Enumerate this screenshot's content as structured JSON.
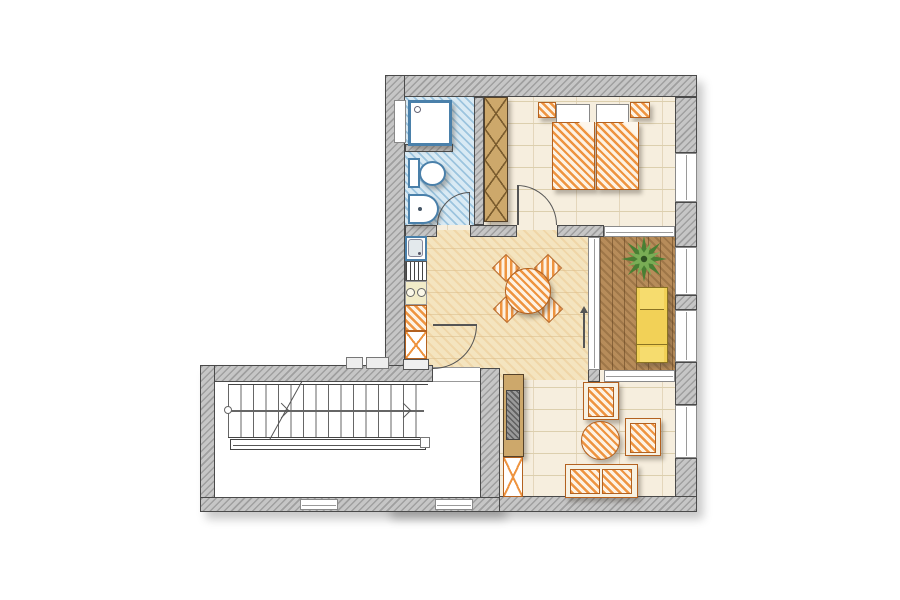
{
  "document": {
    "type": "architectural-floor-plan",
    "style": "hand-drawn color sketch, top-down apartment plan with stairwell wing",
    "visible_text": []
  },
  "colors": {
    "wall": "#c6c6c6",
    "wall_hatch": "#9f9f9f",
    "outline": "#4a4a4a",
    "floor": "#f6eede",
    "floor_line": "#dccfae",
    "dining_floor": "#f4e4bf",
    "bath_floor": "#d9eaf4",
    "bath_hatch": "#9cc4de",
    "fixture_blue": "#4a80aa",
    "balcony_floor": "#b78c5a",
    "orange": "#ee9440",
    "orange_line": "#b3611f",
    "tan": "#cda86b",
    "tan_line": "#7a5c2e",
    "yellow": "#f2d157",
    "yellow_line": "#8a7322",
    "green_dark": "#497f33",
    "green_light": "#79ad55"
  },
  "rooms": [
    {
      "id": "bathroom",
      "position": "top-left",
      "floor": "blue tile",
      "fixtures": [
        "shower-tray",
        "toilet",
        "washbasin"
      ],
      "door": "swings-in from south wall"
    },
    {
      "id": "bedroom",
      "position": "top-right",
      "floor": "cream tile",
      "furniture": [
        "double-bed with two mattresses and two pillows",
        "nightstand-left",
        "nightstand-right",
        "tall-wardrobe"
      ],
      "door": "swings-in from south wall",
      "windows": [
        "east-wall window"
      ]
    },
    {
      "id": "kitchen-dining",
      "position": "center",
      "floor": "warm tan tile",
      "furniture": [
        "kitchen-sink-unit",
        "dish-drainer",
        "cooktop-two-burners",
        "counter",
        "base-cabinet",
        "round-dining-table",
        "dining-chair x4 (rotated 45deg)"
      ],
      "door": "entry door from stair landing"
    },
    {
      "id": "balcony",
      "position": "right",
      "floor": "wood planks",
      "furniture": [
        "potted-plant",
        "sun-lounger"
      ],
      "enclosure": "glazing on all sides"
    },
    {
      "id": "living-area",
      "position": "bottom-right",
      "floor": "cream tile",
      "furniture": [
        "sideboard",
        "base-cabinet",
        "armchair x2",
        "round-coffee-table",
        "two-seat-sofa"
      ],
      "windows": [
        "east-wall window",
        "south-wall solid"
      ]
    },
    {
      "id": "stairwell",
      "position": "bottom-left",
      "floor": "white",
      "elements": [
        "straight-stair with treads",
        "walking-line with direction arrows",
        "break-line",
        "handrail",
        "landing",
        "two south windows"
      ]
    }
  ]
}
